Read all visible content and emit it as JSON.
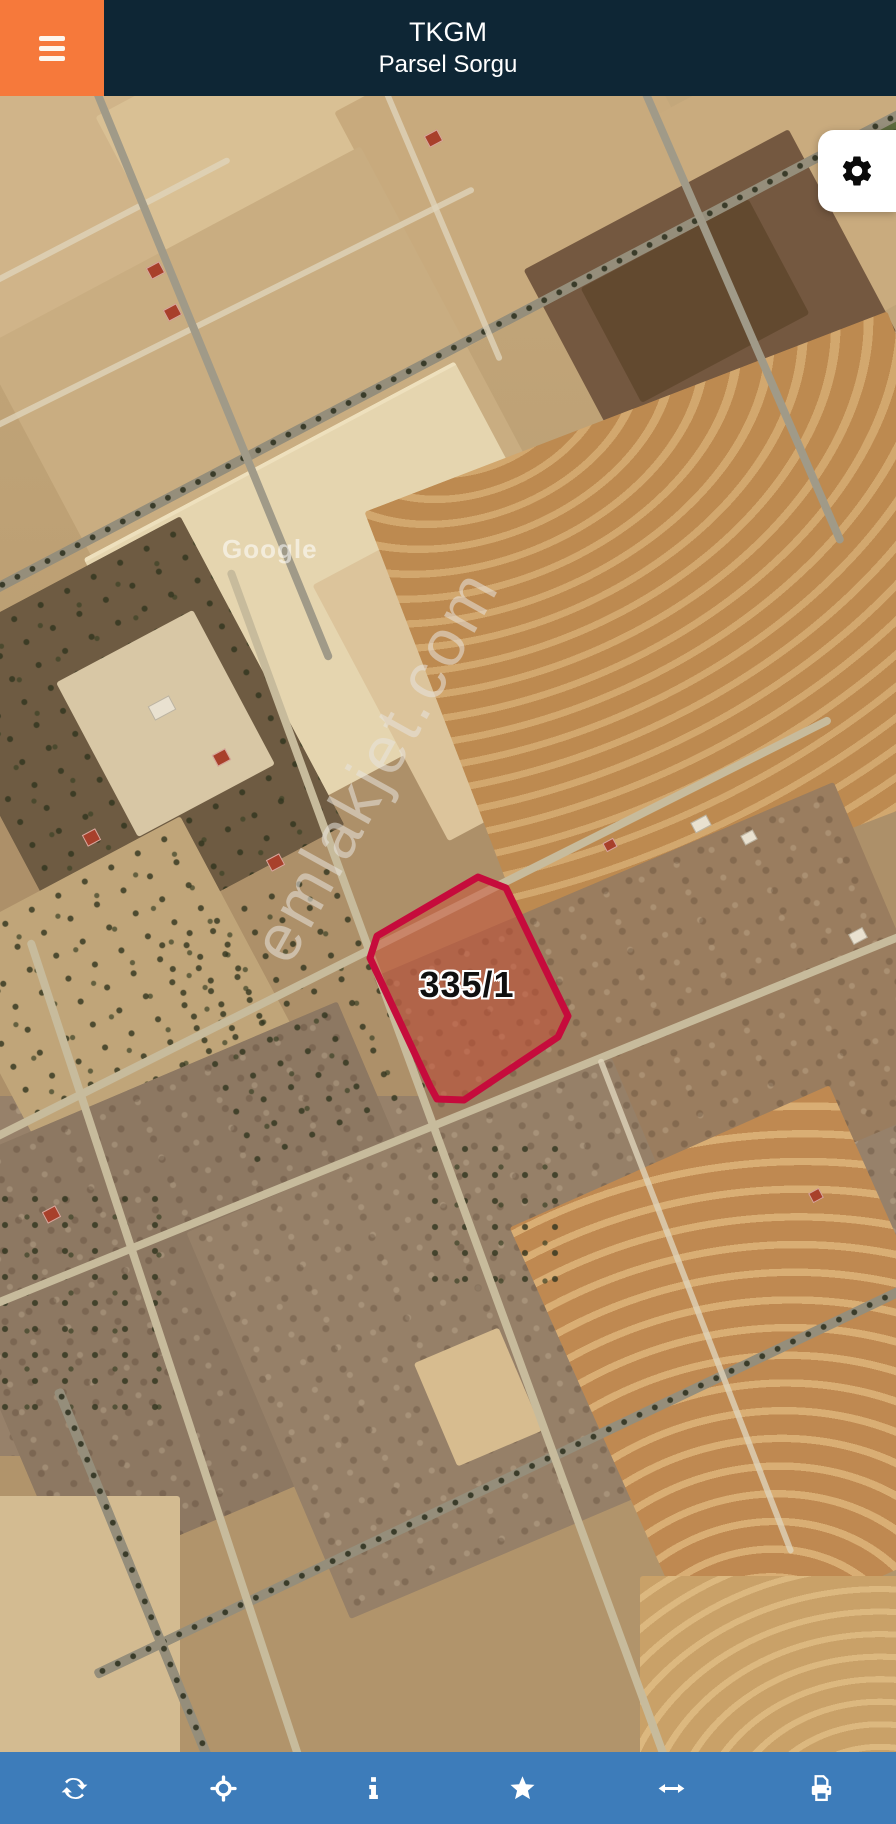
{
  "header": {
    "title_line1": "TKGM",
    "title_line2": "Parsel Sorgu"
  },
  "map": {
    "type": "satellite-imagery",
    "parcel": {
      "label": "335/1",
      "points": "478,781 506,792 568,920 558,941 464,1004 437,1003 430,990 370,862 377,840",
      "border_color": "#c60b3c",
      "fill_color": "rgba(205,72,48,0.47)"
    },
    "watermark_text": "emlakjet.com",
    "imagery_credit": "Google"
  },
  "menu_button": {
    "icon": "hamburger-icon"
  },
  "settings_button": {
    "icon": "gear-icon"
  },
  "toolbar": {
    "background_color": "#3d7cba",
    "items": [
      {
        "name": "refresh",
        "icon": "refresh-icon"
      },
      {
        "name": "locate",
        "icon": "crosshair-icon"
      },
      {
        "name": "info",
        "icon": "info-icon"
      },
      {
        "name": "favorite",
        "icon": "star-icon"
      },
      {
        "name": "extent",
        "icon": "horizontal-arrows-icon"
      },
      {
        "name": "print",
        "icon": "printer-icon"
      }
    ]
  },
  "colors": {
    "header_bg": "#0e2635",
    "menu_button_bg": "#f6793b",
    "toolbar_bg": "#3d7cba",
    "parcel_border": "#c60b3c"
  }
}
